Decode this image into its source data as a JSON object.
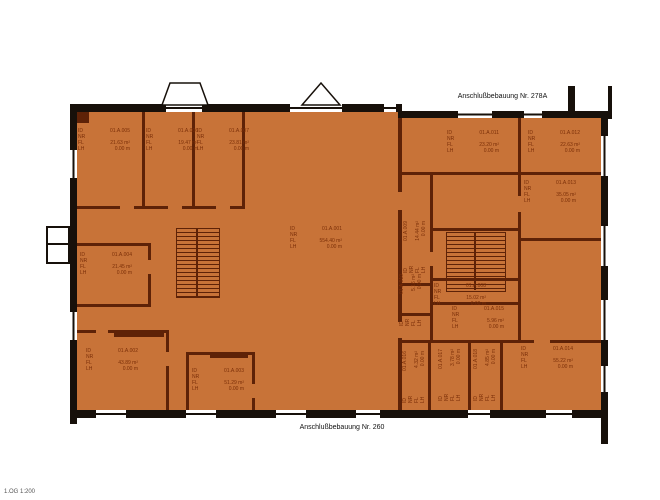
{
  "titles": {
    "top": "Anschlußbebauung Nr. 278A",
    "bottom": "Anschlußbebauung Nr. 260",
    "corner": "1.OG  1:200"
  },
  "labels": {
    "id": "ID",
    "nr": "NR",
    "fl": "FL",
    "lh": "LH"
  },
  "colors": {
    "room_fill": "#c87338",
    "wall": "#17100a",
    "partition": "#5e2207",
    "label_text": "#7b2f08"
  },
  "rooms": [
    {
      "id": "01.A.001",
      "area": "554.40 m²",
      "height": "0.00 m"
    },
    {
      "id": "01.A.002",
      "area": "43.89 m²",
      "height": "0.00 m"
    },
    {
      "id": "01.A.003",
      "area": "51.29 m²",
      "height": "0.00 m"
    },
    {
      "id": "01.A.004",
      "area": "21.45 m²",
      "height": "0.00 m"
    },
    {
      "id": "01.A.005",
      "area": "21.63 m²",
      "height": "0.00 m"
    },
    {
      "id": "01.A.006",
      "area": "19.47 m²",
      "height": "0.00 m"
    },
    {
      "id": "01.A.007",
      "area": "23.81 m²",
      "height": "0.00 m"
    },
    {
      "id": "01.A.008",
      "area": "15.02 m²",
      "height": "0.00 m"
    },
    {
      "id": "01.A.009",
      "area": "14.44 m²",
      "height": "0.00 m"
    },
    {
      "id": "01.A.010",
      "area": "5.16 m²",
      "height": "0.00 m"
    },
    {
      "id": "01.A.011",
      "area": "23.20 m²",
      "height": "0.00 m"
    },
    {
      "id": "01.A.012",
      "area": "22.63 m²",
      "height": "0.00 m"
    },
    {
      "id": "01.A.013",
      "area": "35.05 m²",
      "height": "0.00 m"
    },
    {
      "id": "01.A.014",
      "area": "55.22 m²",
      "height": "0.00 m"
    },
    {
      "id": "01.A.015",
      "area": "5.96 m²",
      "height": "0.00 m"
    },
    {
      "id": "01.A.016",
      "area": "4.32 m²",
      "height": "0.00 m"
    },
    {
      "id": "01.A.017",
      "area": "3.78 m²",
      "height": "0.00 m"
    },
    {
      "id": "01.A.018",
      "area": "4.85 m²",
      "height": "0.00 m"
    }
  ]
}
